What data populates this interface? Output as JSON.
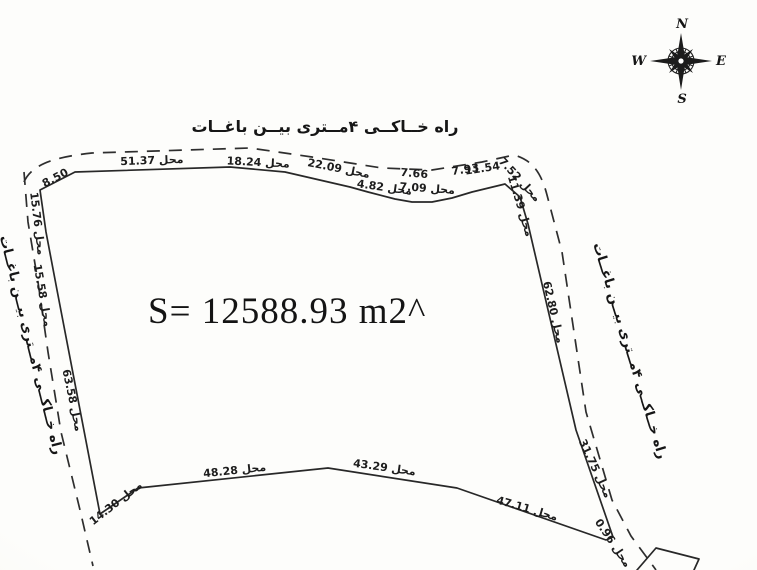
{
  "area": {
    "label": "S= 12588.93 m2^"
  },
  "roads": {
    "top": "راه خــاکــی ۴مــتری بیــن باغــات",
    "left": "راه خــاکــی ۴مــتری بیــن باغــات",
    "right": "راه خــاکــی ۴مــتری بیــن باغــات"
  },
  "compass": {
    "north": "N",
    "east": "E",
    "south": "S",
    "west": "W"
  },
  "dimensions": [
    {
      "label": "8.50"
    },
    {
      "label": "محل 51.37"
    },
    {
      "label": "محل 18.24"
    },
    {
      "label": "محل 22.09"
    },
    {
      "label": "7.66"
    },
    {
      "label": "محل 4.82"
    },
    {
      "label": "محل 7.09"
    },
    {
      "label": "7.93"
    },
    {
      "label": "11.54"
    },
    {
      "label": "7.52 محل"
    },
    {
      "label": "11.39 محل"
    },
    {
      "label": "محل 62.80"
    },
    {
      "label": "محل 31.75"
    },
    {
      "label": "0.96 محل"
    },
    {
      "label": "محل 47.11"
    },
    {
      "label": "محل 43.29"
    },
    {
      "label": "محل 48.28"
    },
    {
      "label": "محل 14.30"
    },
    {
      "label": "محل 63.58"
    },
    {
      "label": "محل 15.58"
    },
    {
      "label": "15.76 محل"
    }
  ]
}
